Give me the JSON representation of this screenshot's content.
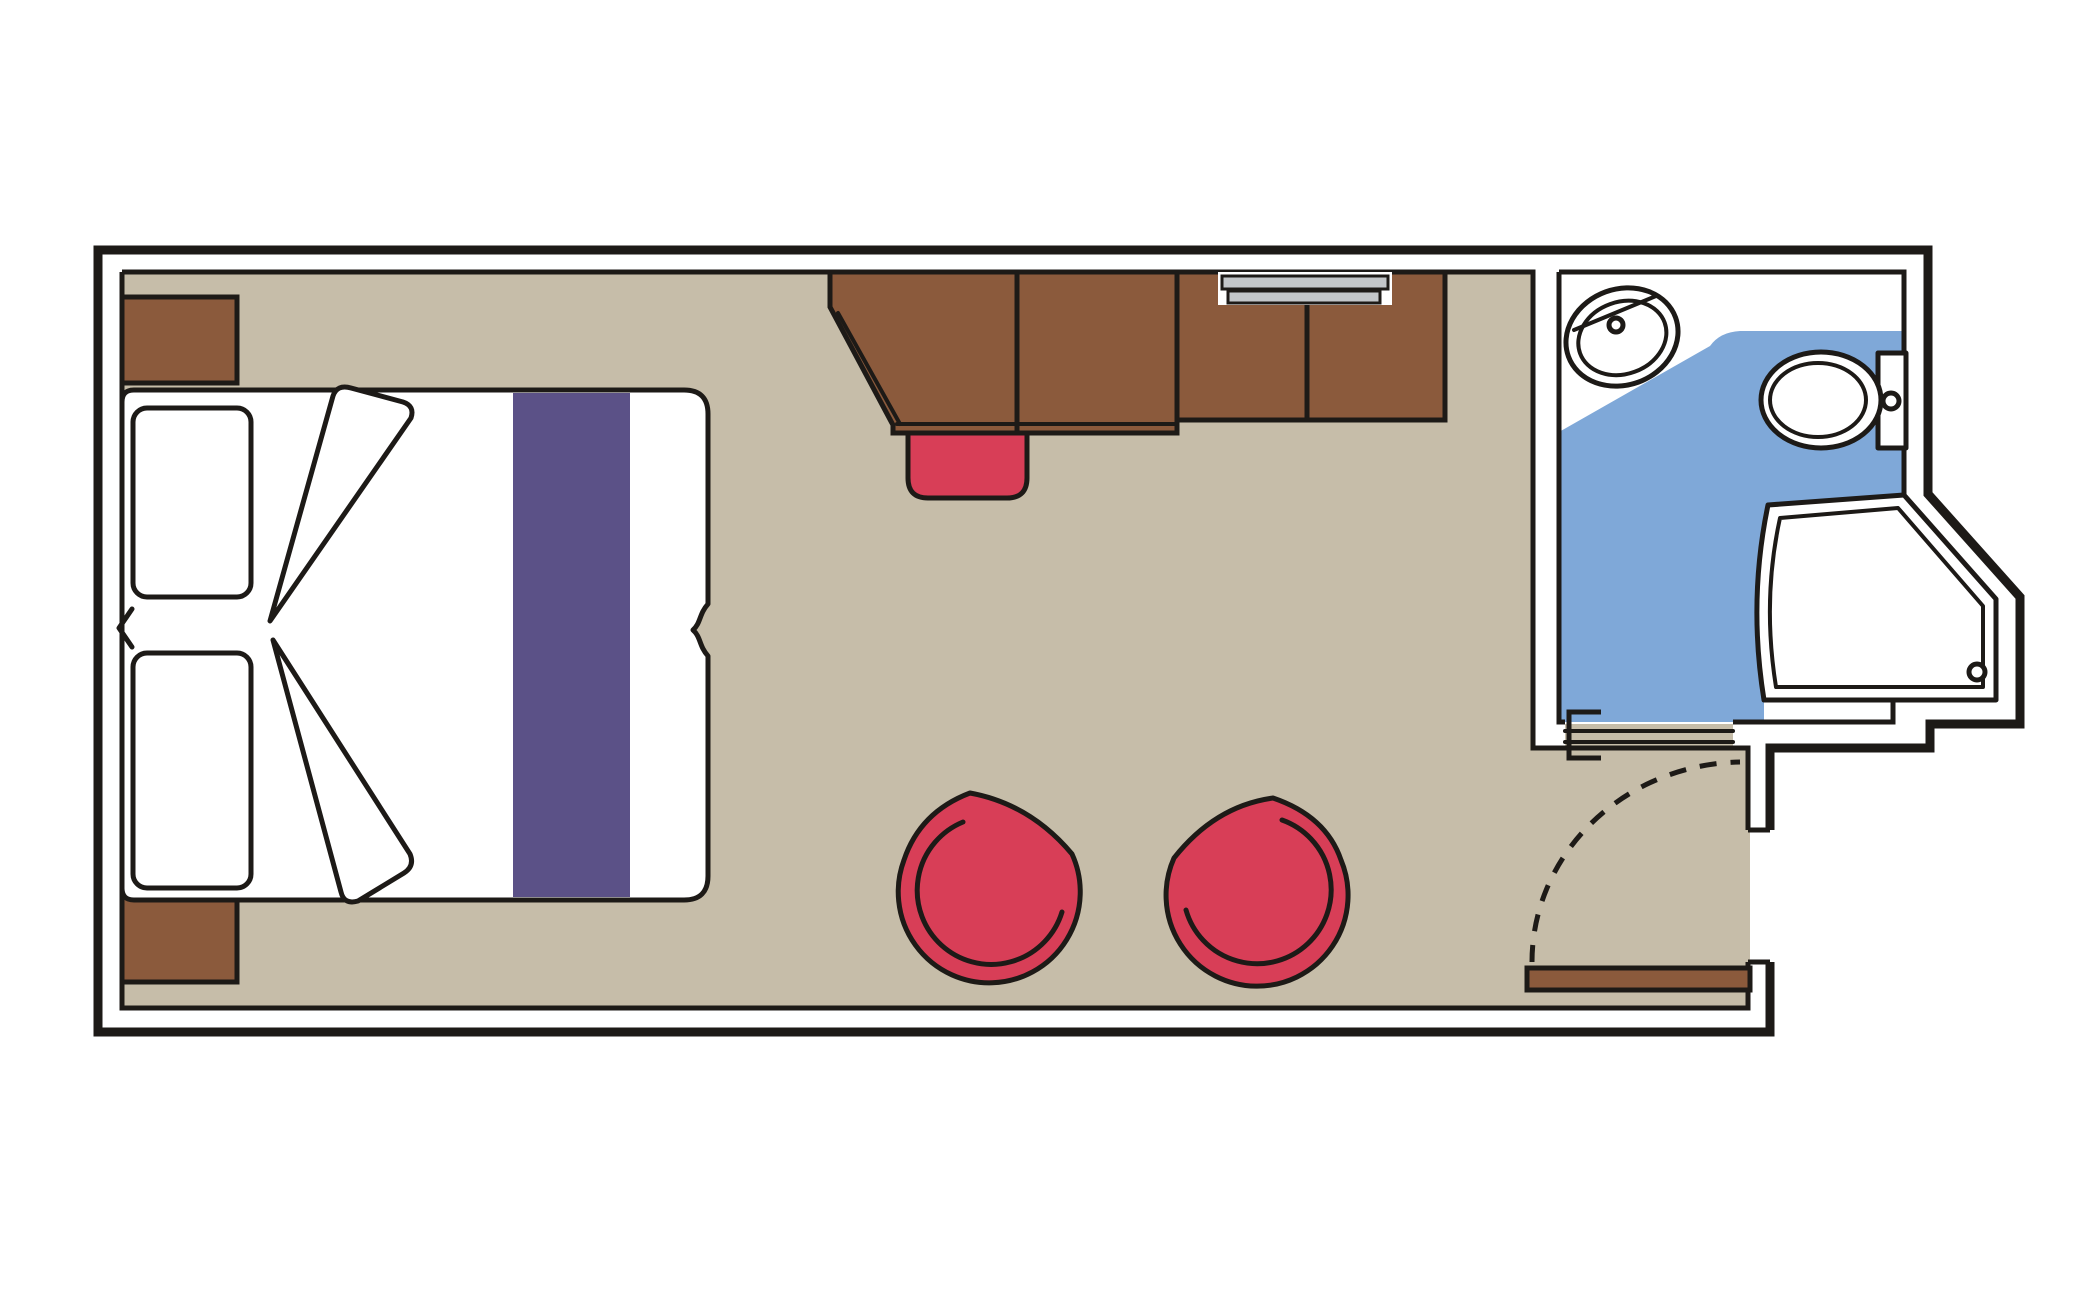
{
  "colors": {
    "ink": "#1d1a17",
    "floor": "#c6bda9",
    "wood": "#8b5a3c",
    "red": "#d83e57",
    "purple": "#5b5187",
    "blue": "#7fa8d8",
    "gray": "#c3c6c9",
    "white": "#ffffff",
    "bg": "#ffffff"
  },
  "items": {
    "plan": "stateroom-floor-plan",
    "walls": "cabin-walls",
    "floor": "cabin-floor",
    "bed": "double-bed",
    "runner": "bed-runner",
    "pillow_top": "pillow",
    "pillow_bottom": "pillow",
    "duvet_fold_upper": "duvet-fold",
    "duvet_fold_lower": "duvet-fold",
    "mattress_split": "mattress-join-marker",
    "nightstand_top": "nightstand",
    "nightstand_bottom": "nightstand",
    "desk": "desk",
    "stool": "desk-stool",
    "wardrobe": "wardrobe",
    "rail": "wardrobe-hanging-rail",
    "chair_left": "tub-chair",
    "chair_right": "tub-chair",
    "bathroom": "bathroom",
    "bathroom_floor": "bathroom-floor",
    "sink": "washbasin",
    "toilet": "toilet",
    "shower": "shower-enclosure",
    "shower_drain": "shower-drain",
    "sliding_door": "bathroom-sliding-door",
    "entry_door": "entry-door-leaf",
    "door_swing": "door-swing-arc"
  }
}
